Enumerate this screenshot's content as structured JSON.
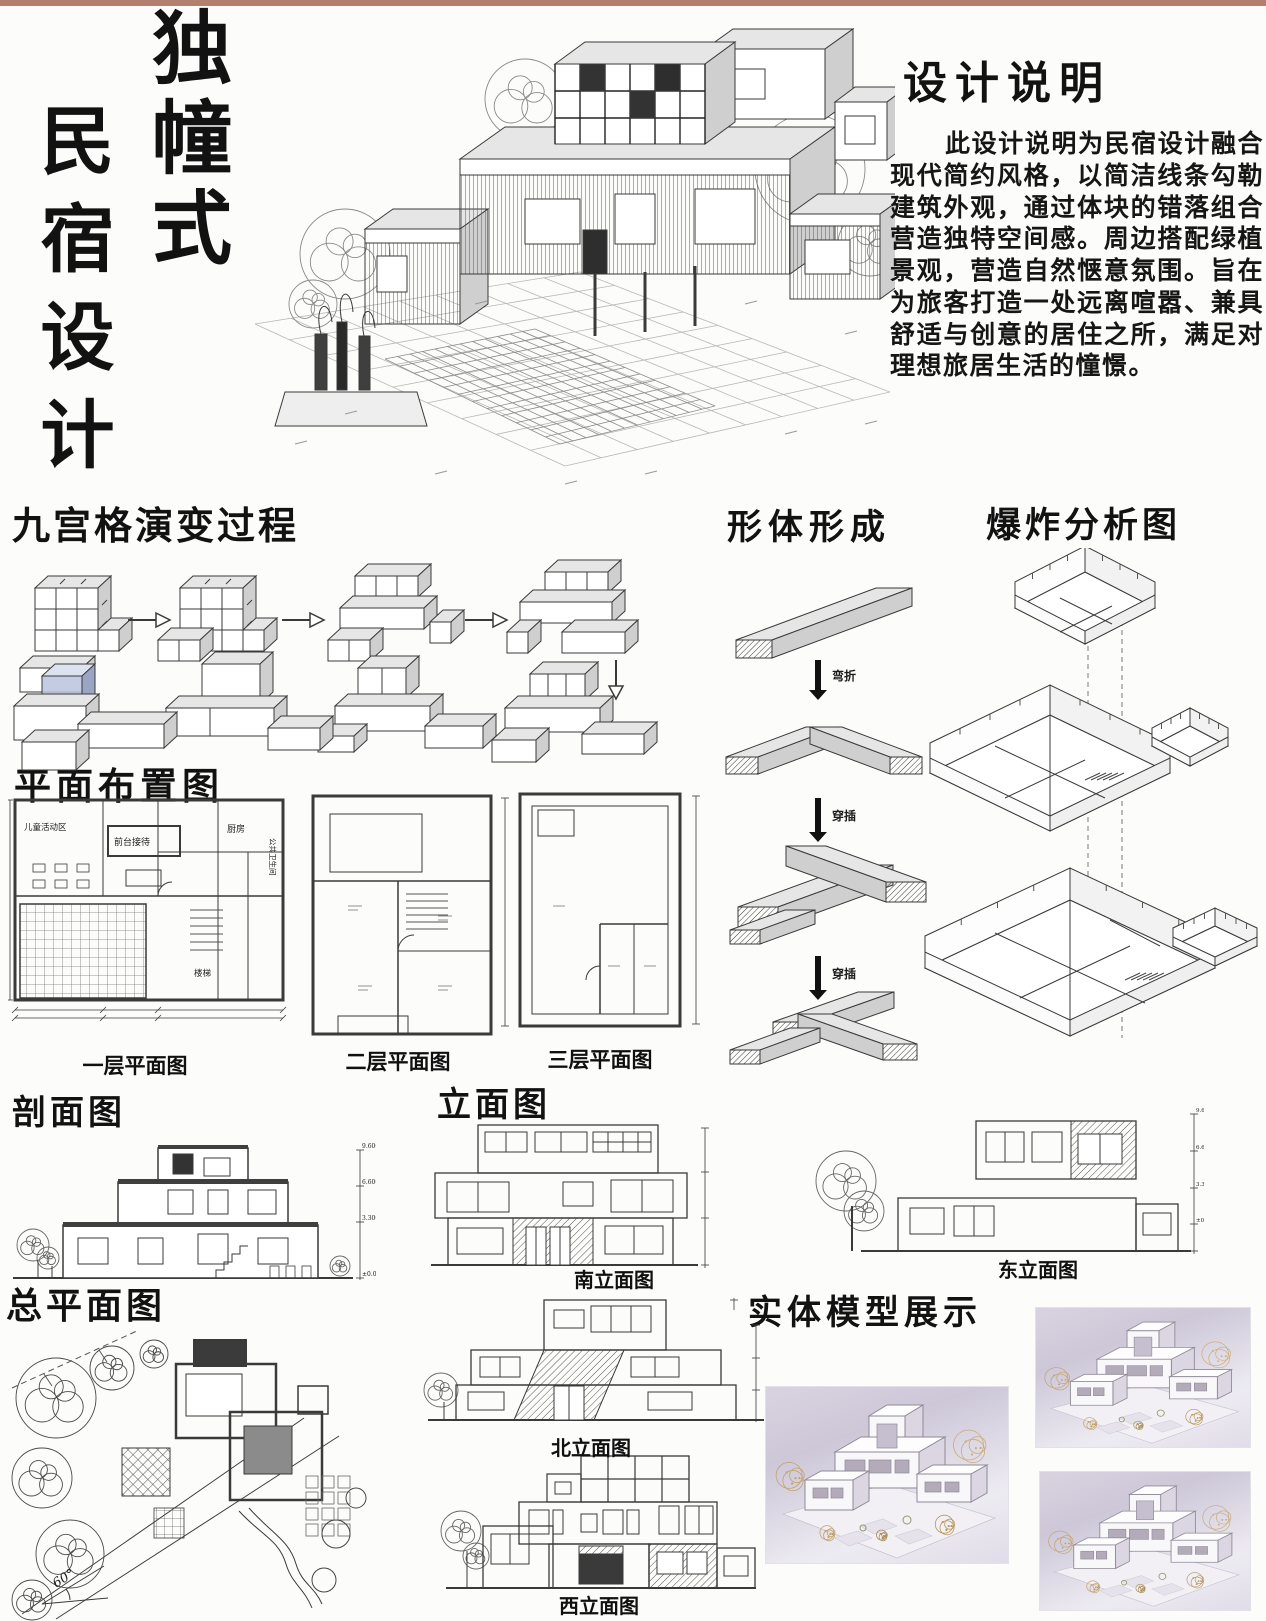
{
  "poster": {
    "background": "#fcfcfb",
    "top_strip_color": "#b1806f"
  },
  "title": {
    "vertical_main": "独幢式",
    "vertical_sub": "民宿设计"
  },
  "design_notes": {
    "heading": "设计说明",
    "body": "此设计说明为民宿设计融合现代简约风格，以简洁线条勾勒建筑外观，通过体块的错落组合营造独特空间感。周边搭配绿植景观，营造自然惬意氛围。旨在为旅客打造一处远离喧嚣、兼具舒适与创意的居住之所，满足对理想旅居生活的憧憬。"
  },
  "grid_evolution": {
    "heading": "九宫格演变过程"
  },
  "form_formation": {
    "heading": "形体形成",
    "steps": [
      "弯折",
      "穿插",
      "穿插"
    ]
  },
  "exploded": {
    "heading": "爆炸分析图"
  },
  "floor_plans": {
    "heading": "平面布置图",
    "captions": [
      "一层平面图",
      "二层平面图",
      "三层平面图"
    ],
    "room_labels": {
      "kids": "儿童活动区",
      "reception": "前台接待",
      "kitchen": "厨房",
      "wc": "公共卫生间",
      "stairs": "楼梯"
    }
  },
  "section_view": {
    "heading": "剖面图",
    "levels": [
      "9.600",
      "6.600",
      "3.300",
      "±0.000"
    ]
  },
  "elevations": {
    "heading": "立面图",
    "south": "南立面图",
    "east": "东立面图",
    "north": "北立面图",
    "west": "西立面图"
  },
  "site_plan": {
    "heading": "总平面图",
    "angle_label": "60°"
  },
  "model_display": {
    "heading": "实体模型展示"
  }
}
